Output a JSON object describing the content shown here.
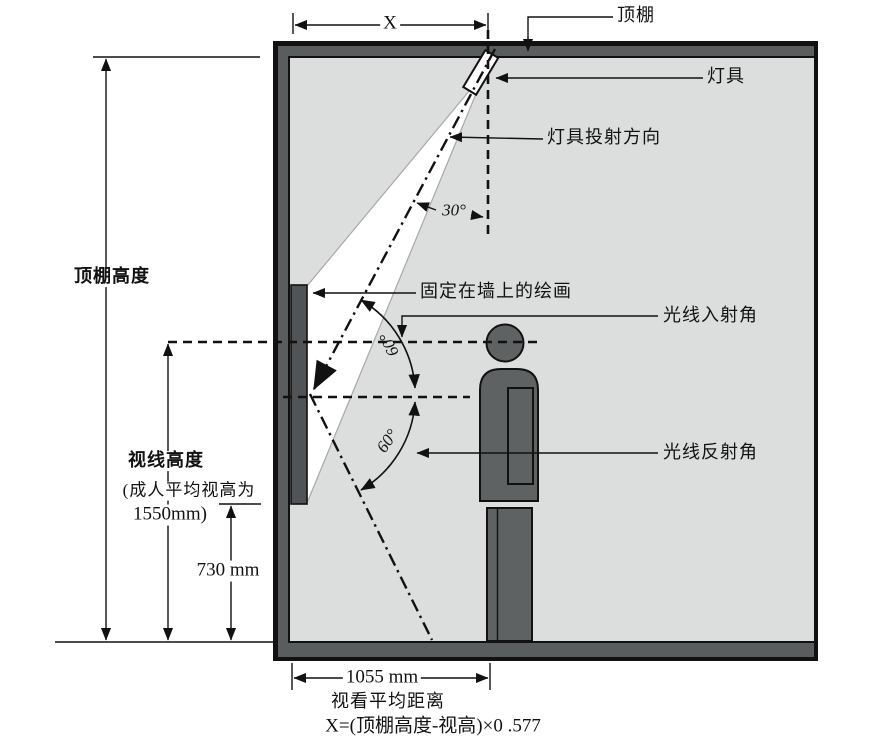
{
  "figure": {
    "title_hint": "museum wall-painting lighting geometry diagram",
    "labels": {
      "ceiling": "顶棚",
      "lamp": "灯具",
      "lamp_direction": "灯具投射方向",
      "tilt_angle": "30°",
      "painting": "固定在墙上的绘画",
      "incidence": "光线入射角",
      "reflection": "光线反射角",
      "incidence_angle_value": "60°",
      "reflection_angle_value": "60°"
    },
    "dimensions": {
      "x": "X",
      "ceiling_height": "顶棚高度",
      "sight_height": "视线高度",
      "sight_height_note_1": "(成人平均视高为",
      "sight_height_note_2": "1550mm)",
      "painting_bottom_height": "730 mm",
      "viewing_distance_value": "1055 mm",
      "viewing_distance_label": "视看平均距离",
      "formula": "X=(顶棚高度-视高)×0 .577"
    },
    "colors": {
      "wall": "#595d5e",
      "interior": "#dcdddd",
      "beam": "#ffffff",
      "figure": "#5f6263",
      "painting": "#505456",
      "line": "#111111"
    }
  }
}
